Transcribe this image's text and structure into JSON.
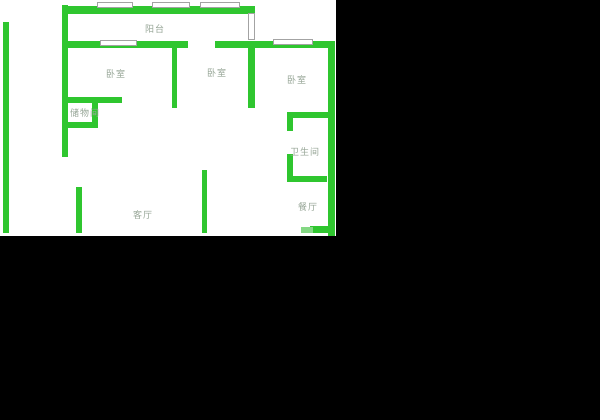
{
  "canvas": {
    "width": 600,
    "height": 420,
    "background": "#000000"
  },
  "floorplan": {
    "area": {
      "x": 0,
      "y": 0,
      "width": 336,
      "height": 236,
      "background": "#ffffff"
    },
    "colors": {
      "wall": "#2fc62f",
      "wall_muted": "#84d884",
      "window_fill": "#ffffff",
      "window_border": "#a3a3a3",
      "label": "#97a697"
    },
    "rooms": [
      {
        "name": "balcony",
        "label": "阳台",
        "x": 145,
        "y": 26
      },
      {
        "name": "bedroom-left",
        "label": "卧室",
        "x": 106,
        "y": 71
      },
      {
        "name": "bedroom-middle",
        "label": "卧室",
        "x": 207,
        "y": 70
      },
      {
        "name": "bedroom-right",
        "label": "卧室",
        "x": 287,
        "y": 77
      },
      {
        "name": "storage-room",
        "label": "储物间",
        "x": 70,
        "y": 110
      },
      {
        "name": "bathroom",
        "label": "卫生间",
        "x": 290,
        "y": 149
      },
      {
        "name": "dining-room",
        "label": "餐厅",
        "x": 298,
        "y": 204
      },
      {
        "name": "living-room",
        "label": "客厅",
        "x": 133,
        "y": 212
      }
    ],
    "walls": [
      {
        "name": "outer-left-wall",
        "x": 3,
        "y": 22,
        "w": 6,
        "h": 211
      },
      {
        "name": "interior-left-wall",
        "x": 62,
        "y": 5,
        "w": 6,
        "h": 152
      },
      {
        "name": "balcony-top-wall",
        "x": 62,
        "y": 6,
        "w": 193,
        "h": 8
      },
      {
        "name": "north-wall-west",
        "x": 62,
        "y": 41,
        "w": 126,
        "h": 7
      },
      {
        "name": "north-wall-east",
        "x": 215,
        "y": 41,
        "w": 120,
        "h": 7
      },
      {
        "name": "bedroom-divider-west",
        "x": 172,
        "y": 41,
        "w": 5,
        "h": 67
      },
      {
        "name": "bedroom-divider-east",
        "x": 248,
        "y": 41,
        "w": 7,
        "h": 67
      },
      {
        "name": "outer-right-wall",
        "x": 328,
        "y": 41,
        "w": 7,
        "h": 195
      },
      {
        "name": "bathroom-top-wall",
        "x": 287,
        "y": 112,
        "w": 41,
        "h": 6
      },
      {
        "name": "bathroom-left-wall-upper",
        "x": 287,
        "y": 118,
        "w": 6,
        "h": 13
      },
      {
        "name": "bathroom-left-wall-lower",
        "x": 287,
        "y": 154,
        "w": 6,
        "h": 28
      },
      {
        "name": "bathroom-bottom-wall",
        "x": 287,
        "y": 176,
        "w": 40,
        "h": 6
      },
      {
        "name": "storage-top-wall",
        "x": 62,
        "y": 97,
        "w": 60,
        "h": 6
      },
      {
        "name": "storage-right-wall",
        "x": 92,
        "y": 103,
        "w": 6,
        "h": 25
      },
      {
        "name": "storage-bottom-wall",
        "x": 62,
        "y": 122,
        "w": 36,
        "h": 6
      },
      {
        "name": "living-room-left-wall",
        "x": 76,
        "y": 187,
        "w": 6,
        "h": 46
      },
      {
        "name": "living-dining-divider",
        "x": 202,
        "y": 170,
        "w": 5,
        "h": 63
      },
      {
        "name": "dining-south-stub",
        "x": 310,
        "y": 226,
        "w": 22,
        "h": 7
      },
      {
        "name": "dining-south-stub-muted",
        "x": 301,
        "y": 227,
        "w": 12,
        "h": 6,
        "muted": true
      }
    ],
    "windows": [
      {
        "name": "balcony-window-1",
        "x": 97,
        "y": 2,
        "w": 36,
        "h": 6
      },
      {
        "name": "balcony-window-2",
        "x": 152,
        "y": 2,
        "w": 38,
        "h": 6
      },
      {
        "name": "balcony-window-3",
        "x": 200,
        "y": 2,
        "w": 40,
        "h": 6
      },
      {
        "name": "balcony-side-window",
        "x": 248,
        "y": 13,
        "w": 7,
        "h": 27
      },
      {
        "name": "north-wall-window",
        "x": 100,
        "y": 40,
        "w": 37,
        "h": 6
      },
      {
        "name": "bedroom-right-window",
        "x": 273,
        "y": 39,
        "w": 40,
        "h": 6
      }
    ]
  }
}
